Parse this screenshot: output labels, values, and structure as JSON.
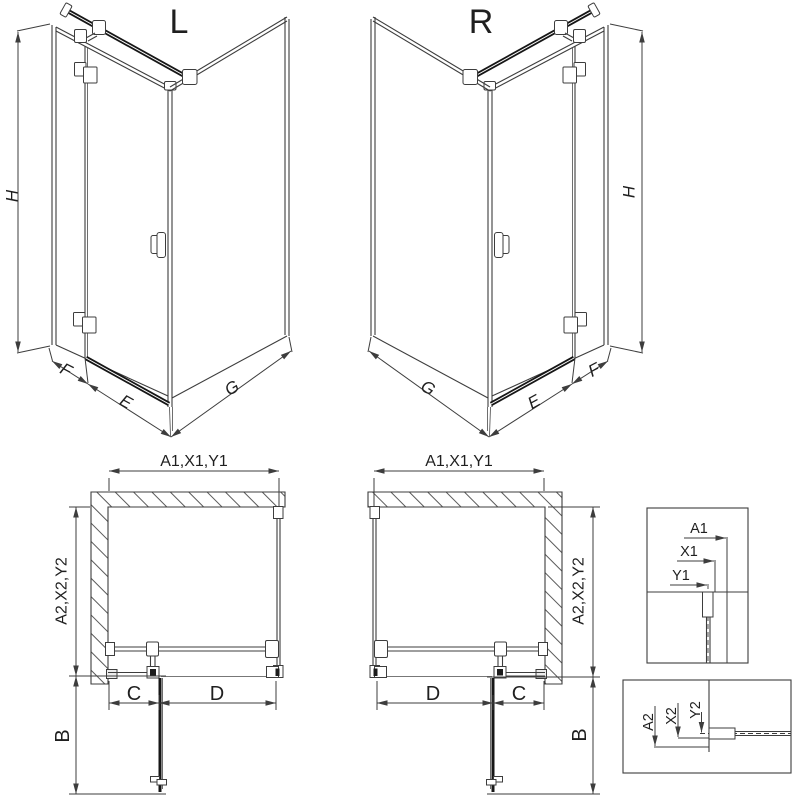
{
  "drawing_type": "shower-enclosure-dimension-diagram",
  "colors": {
    "background": "#ffffff",
    "line": "#3d3d3d",
    "heavy_bar": "#161616",
    "text": "#1f1f1f",
    "hatch": "#5a5a5a"
  },
  "views": {
    "perspective_l": {
      "title": "L",
      "height_dim": "H",
      "fixed_panel_dim": "F",
      "door_dim": "E",
      "side_panel_dim": "G"
    },
    "perspective_r": {
      "title": "R",
      "height_dim": "H",
      "fixed_panel_dim": "F",
      "door_dim": "E",
      "side_panel_dim": "G"
    },
    "plan_l": {
      "width_dim": "A1,X1,Y1",
      "depth_dim": "A2,X2,Y2",
      "fixed_segment_dim": "C",
      "door_segment_dim": "D",
      "door_swing_dim": "B"
    },
    "plan_r": {
      "width_dim": "A1,X1,Y1",
      "depth_dim": "A2,X2,Y2",
      "fixed_segment_dim": "C",
      "door_segment_dim": "D",
      "door_swing_dim": "B"
    },
    "detail_width": {
      "outer_ref": "A1",
      "profile_ref": "X1",
      "glass_ref": "Y1"
    },
    "detail_depth": {
      "outer_ref": "A2",
      "profile_ref": "X2",
      "glass_ref": "Y2"
    }
  }
}
